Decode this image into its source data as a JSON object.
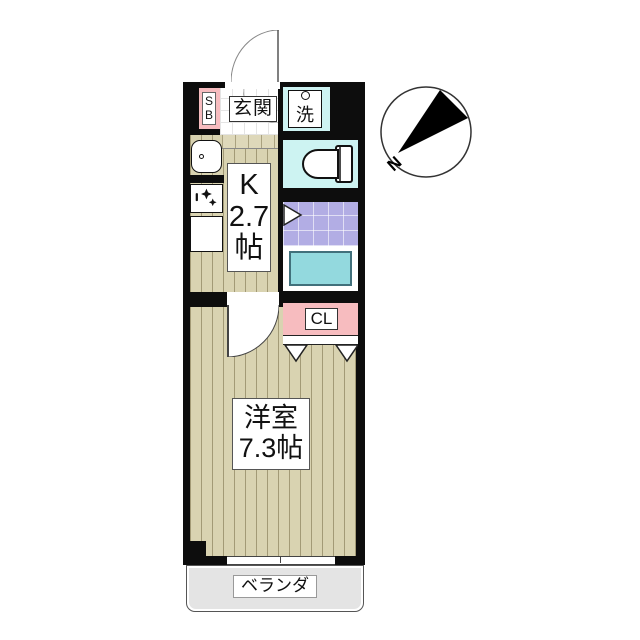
{
  "plan": {
    "type": "apartment-floor-plan",
    "compass": {
      "north_label": "N"
    },
    "entrance": {
      "label": "玄関",
      "shoe_box_lines": [
        "S",
        "B"
      ]
    },
    "laundry": {
      "label": "洗"
    },
    "kitchen": {
      "label_lines": [
        "K",
        "2.7",
        "帖"
      ]
    },
    "closet": {
      "label": "CL"
    },
    "western_room": {
      "label_lines": [
        "洋室",
        "7.3帖"
      ]
    },
    "veranda": {
      "label": "ベランダ"
    },
    "fixtures": [
      "sink",
      "stove",
      "counter",
      "toilet",
      "bathtub",
      "washing-machine",
      "entry-door",
      "room-door",
      "closet-folding-door",
      "sliding-window"
    ],
    "colors": {
      "wall": "#0d0d0d",
      "wood_floor": "#d9d3b1",
      "entrance_tile": "#ffffff",
      "closet_pink": "#f7bcbf",
      "water_cyan": "#cdf3f2",
      "bath_lavender": "#b2ade4",
      "bathtub_teal": "#93d9de",
      "veranda_gray": "#e4e4e4"
    }
  }
}
